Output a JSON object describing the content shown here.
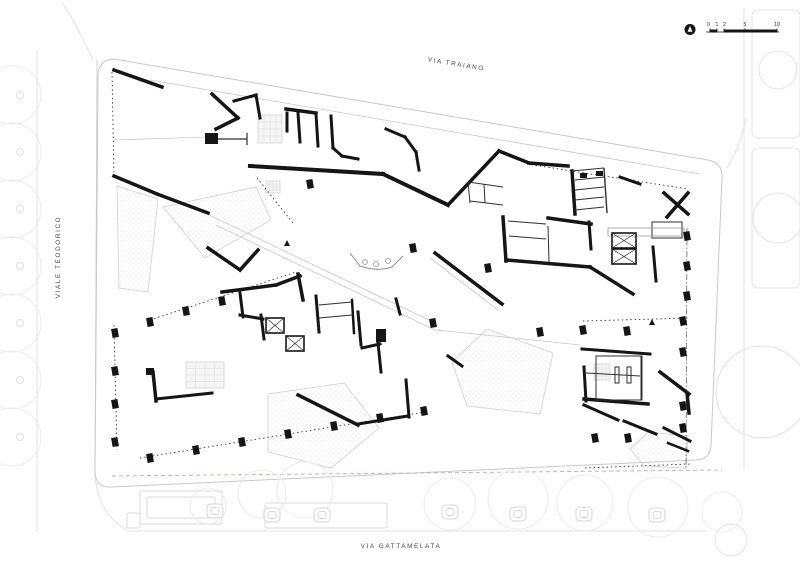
{
  "colors": {
    "ink": "#151515",
    "thin": "#2e2e2e",
    "faint": "#c9c9c9",
    "context": "#e3e3e3",
    "landscape_stroke": "#cfcfcf",
    "landscape_fill": "#f5f5f5",
    "boundary_dash": "#d4a8a8"
  },
  "labels": {
    "street_top": "VIA TRAIANO",
    "street_left": "VIALE TEODORICO",
    "street_bottom": "VIA GATTAMELATA"
  },
  "scalebar": {
    "ticks": [
      "0",
      "1",
      "2",
      "5",
      "10"
    ],
    "tick_x": [
      710,
      717,
      724,
      745,
      777
    ]
  },
  "drawing": {
    "site_outline": "M114,59 L708,160 Q723,163 722,178 L711,446 Q710,459 696,460 L111,487 Q96,488 95,472 L98,76 Q98,60 114,59 Z",
    "context_curves": [
      "M62,2 Q80,30 93,60",
      "M95,472 Q96,512 128,531",
      "M727,168 Q740,148 746,118"
    ],
    "context_lines": [
      [
        744,
        8,
        744,
        470
      ],
      [
        128,
        531,
        707,
        531
      ],
      [
        37,
        50,
        37,
        532
      ]
    ],
    "context_rects": [
      [
        752,
        10,
        48,
        128
      ],
      [
        752,
        148,
        48,
        140
      ]
    ],
    "context_circles": [
      [
        778,
        70,
        19
      ],
      [
        778,
        218,
        25
      ],
      [
        762,
        392,
        46
      ],
      [
        731,
        540,
        16
      ]
    ],
    "landscape": [
      [
        [
          117,
          186
        ],
        [
          158,
          199
        ],
        [
          148,
          292
        ],
        [
          119,
          288
        ]
      ],
      [
        [
          163,
          207
        ],
        [
          256,
          187
        ],
        [
          271,
          220
        ],
        [
          205,
          258
        ]
      ],
      [
        [
          268,
          394
        ],
        [
          344,
          383
        ],
        [
          379,
          428
        ],
        [
          331,
          468
        ],
        [
          268,
          452
        ]
      ],
      [
        [
          487,
          329
        ],
        [
          553,
          353
        ],
        [
          540,
          414
        ],
        [
          467,
          406
        ],
        [
          452,
          362
        ]
      ],
      [
        [
          648,
          432
        ],
        [
          688,
          436
        ],
        [
          686,
          468
        ],
        [
          644,
          466
        ],
        [
          630,
          449
        ]
      ]
    ],
    "grid_rects": [
      [
        594,
        364,
        16,
        16
      ],
      [
        258,
        115,
        24,
        28
      ],
      [
        266,
        181,
        14,
        12
      ],
      [
        186,
        362,
        38,
        26
      ]
    ],
    "faint_lines": [
      [
        150,
        80,
        700,
        174
      ],
      [
        113,
        140,
        205,
        137
      ],
      [
        207,
        214,
        433,
        322
      ],
      [
        216,
        225,
        437,
        331
      ],
      [
        437,
        330,
        580,
        345
      ],
      [
        97,
        60,
        95,
        470
      ],
      [
        430,
        258,
        498,
        310
      ]
    ],
    "dotted_lines": [
      [
        112,
        72,
        114,
        177
      ],
      [
        257,
        178,
        293,
        223
      ],
      [
        527,
        164,
        688,
        189
      ],
      [
        150,
        320,
        296,
        272
      ],
      [
        114,
        325,
        117,
        450
      ],
      [
        140,
        458,
        425,
        412
      ],
      [
        583,
        321,
        690,
        318
      ],
      [
        585,
        468,
        690,
        464
      ]
    ],
    "dashdot_lines": [
      [
        687,
        228,
        686,
        470
      ]
    ],
    "pink_dashed": [
      [
        112,
        476,
        722,
        470
      ]
    ],
    "walls": [
      [
        114,
        70,
        162,
        87,
        3.5
      ],
      [
        114,
        176,
        157,
        194,
        3.5
      ],
      [
        157,
        194,
        208,
        213,
        3.5
      ],
      [
        212,
        94,
        238,
        118,
        3.5
      ],
      [
        238,
        118,
        216,
        129,
        3.5
      ],
      [
        234,
        101,
        256,
        95,
        3
      ],
      [
        256,
        95,
        260,
        118,
        3
      ],
      [
        208,
        248,
        240,
        270,
        3.5
      ],
      [
        240,
        270,
        258,
        250,
        3.5
      ],
      [
        286,
        109,
        316,
        113,
        3.5
      ],
      [
        287,
        113,
        287,
        131,
        3
      ],
      [
        298,
        113,
        300,
        142,
        3
      ],
      [
        316,
        114,
        318,
        146,
        3
      ],
      [
        331,
        116,
        333,
        148,
        3
      ],
      [
        333,
        148,
        342,
        156,
        3
      ],
      [
        342,
        156,
        358,
        159,
        3
      ],
      [
        250,
        166,
        383,
        174,
        4
      ],
      [
        383,
        174,
        448,
        205,
        4
      ],
      [
        448,
        205,
        499,
        151,
        3.5
      ],
      [
        499,
        151,
        529,
        163,
        3.5
      ],
      [
        529,
        163,
        568,
        166,
        3.5
      ],
      [
        386,
        129,
        405,
        137,
        3
      ],
      [
        405,
        137,
        416,
        152,
        3
      ],
      [
        416,
        152,
        419,
        170,
        3
      ],
      [
        435,
        253,
        502,
        304,
        3.5
      ],
      [
        448,
        356,
        462,
        366,
        3
      ],
      [
        572,
        171,
        575,
        214,
        3.5
      ],
      [
        548,
        218,
        591,
        224,
        3.5
      ],
      [
        589,
        222,
        591,
        249,
        3
      ],
      [
        503,
        217,
        506,
        261,
        3.5
      ],
      [
        506,
        260,
        590,
        267,
        3.5
      ],
      [
        590,
        267,
        633,
        294,
        3.5
      ],
      [
        653,
        247,
        656,
        281,
        3
      ],
      [
        664,
        193,
        688,
        214,
        3.5
      ],
      [
        688,
        193,
        667,
        217,
        3.5
      ],
      [
        620,
        177,
        640,
        184,
        3
      ],
      [
        582,
        349,
        650,
        354,
        3
      ],
      [
        584,
        367,
        586,
        401,
        3
      ],
      [
        584,
        399,
        648,
        404,
        3.5
      ],
      [
        584,
        405,
        618,
        420,
        3
      ],
      [
        624,
        421,
        656,
        434,
        3
      ],
      [
        660,
        372,
        689,
        394,
        3.5
      ],
      [
        687,
        393,
        689,
        413,
        3.5
      ],
      [
        664,
        428,
        690,
        441,
        3
      ],
      [
        668,
        443,
        688,
        451,
        2.5
      ],
      [
        222,
        292,
        276,
        285,
        3.5
      ],
      [
        276,
        285,
        300,
        276,
        3.5
      ],
      [
        298,
        274,
        303,
        300,
        3.5
      ],
      [
        240,
        293,
        243,
        317,
        3
      ],
      [
        240,
        315,
        263,
        319,
        3
      ],
      [
        261,
        315,
        264,
        339,
        3
      ],
      [
        316,
        296,
        319,
        332,
        3
      ],
      [
        352,
        300,
        354,
        333,
        2.5
      ],
      [
        153,
        372,
        156,
        401,
        3.5
      ],
      [
        156,
        399,
        212,
        393,
        3
      ],
      [
        358,
        312,
        361,
        345,
        3
      ],
      [
        362,
        348,
        380,
        344,
        3
      ],
      [
        378,
        343,
        381,
        372,
        3
      ],
      [
        298,
        395,
        358,
        425,
        3.5
      ],
      [
        358,
        424,
        408,
        416,
        3
      ],
      [
        406,
        380,
        409,
        417,
        3
      ],
      [
        396,
        299,
        400,
        314,
        3
      ]
    ],
    "thin_lines": [
      [
        218,
        139,
        247,
        139,
        1.2
      ],
      [
        247,
        133,
        247,
        145,
        1.2
      ],
      [
        575,
        180,
        604,
        177,
        1
      ],
      [
        575,
        190,
        604,
        187,
        1
      ],
      [
        575,
        200,
        604,
        197,
        1
      ],
      [
        575,
        210,
        604,
        207,
        1
      ],
      [
        572,
        171,
        604,
        168,
        1
      ],
      [
        604,
        168,
        607,
        213,
        1.4
      ],
      [
        319,
        305,
        352,
        302,
        1
      ],
      [
        319,
        318,
        352,
        315,
        1
      ],
      [
        508,
        221,
        546,
        224,
        1
      ],
      [
        509,
        236,
        546,
        239,
        1
      ],
      [
        548,
        226,
        549,
        262,
        1
      ],
      [
        596,
        356,
        596,
        400,
        1
      ],
      [
        641,
        356,
        641,
        400,
        1
      ],
      [
        586,
        373,
        640,
        376,
        1
      ],
      [
        468,
        182,
        503,
        187,
        1
      ],
      [
        468,
        182,
        470,
        203,
        1
      ],
      [
        470,
        201,
        503,
        205,
        1
      ],
      [
        484,
        184,
        485,
        203,
        1
      ]
    ],
    "thin_rects": [
      [
        615,
        367,
        4,
        16
      ],
      [
        627,
        367,
        4,
        16
      ],
      [
        652,
        222,
        30,
        16
      ],
      [
        596,
        356,
        46,
        44
      ]
    ],
    "bench_rects": [
      [
        608,
        228,
        76,
        8
      ]
    ],
    "black_rects": [
      [
        205,
        133,
        13,
        11
      ],
      [
        376,
        329,
        10,
        13
      ],
      [
        580,
        173,
        7,
        5
      ],
      [
        596,
        171,
        7,
        5
      ],
      [
        146,
        368,
        8,
        7
      ]
    ],
    "xstairs": [
      [
        266,
        318,
        18,
        15
      ],
      [
        286,
        336,
        18,
        15
      ],
      [
        612,
        233,
        24,
        15
      ],
      [
        612,
        249,
        24,
        15
      ]
    ],
    "columns": [
      [
        115,
        333
      ],
      [
        115,
        371
      ],
      [
        115,
        404
      ],
      [
        115,
        442
      ],
      [
        150,
        322
      ],
      [
        186,
        311
      ],
      [
        222,
        301
      ],
      [
        150,
        458
      ],
      [
        196,
        450
      ],
      [
        242,
        442
      ],
      [
        288,
        434
      ],
      [
        334,
        426
      ],
      [
        380,
        418
      ],
      [
        424,
        411
      ],
      [
        310,
        184
      ],
      [
        413,
        248
      ],
      [
        433,
        323
      ],
      [
        488,
        268
      ],
      [
        540,
        332
      ],
      [
        583,
        330
      ],
      [
        627,
        331
      ],
      [
        683,
        321
      ],
      [
        683,
        352
      ],
      [
        595,
        438
      ],
      [
        628,
        438
      ],
      [
        683,
        406
      ],
      [
        683,
        428
      ],
      [
        687,
        236
      ],
      [
        687,
        266
      ],
      [
        687,
        296
      ]
    ],
    "triangle_markers": [
      [
        652,
        322
      ],
      [
        287,
        243
      ]
    ],
    "desk": {
      "path": "M350,253 L360,266 Q377,272 392,267 L403,256",
      "dots": [
        [
          365,
          262
        ],
        [
          376,
          264
        ],
        [
          388,
          261
        ]
      ]
    },
    "trees_left": {
      "cx": 12,
      "r": 29,
      "trunk_cx": 20,
      "cys": [
        95,
        152,
        209,
        266,
        323,
        380,
        437
      ]
    },
    "trees_bottom": [
      [
        208,
        506,
        18
      ],
      [
        262,
        494,
        24
      ],
      [
        305,
        490,
        28
      ],
      [
        450,
        504,
        26
      ],
      [
        518,
        499,
        30
      ],
      [
        585,
        503,
        28
      ],
      [
        658,
        507,
        30
      ],
      [
        722,
        512,
        20
      ]
    ],
    "tree_pits": [
      [
        215,
        511
      ],
      [
        272,
        515
      ],
      [
        322,
        515
      ],
      [
        450,
        512
      ],
      [
        518,
        514
      ],
      [
        584,
        514
      ],
      [
        657,
        515
      ]
    ],
    "street_rects": [
      [
        140,
        491,
        82,
        33
      ],
      [
        147,
        497,
        68,
        21
      ],
      [
        265,
        503,
        122,
        25
      ],
      [
        127,
        513,
        13,
        15
      ]
    ],
    "scalebar_geo": {
      "baseline": [
        706,
        32,
        779,
        32
      ],
      "bars": [
        [
          710,
          29.5,
          7,
          3
        ],
        [
          724,
          29.5,
          53,
          3
        ]
      ],
      "north": [
        690,
        29.5,
        5.5
      ]
    }
  }
}
